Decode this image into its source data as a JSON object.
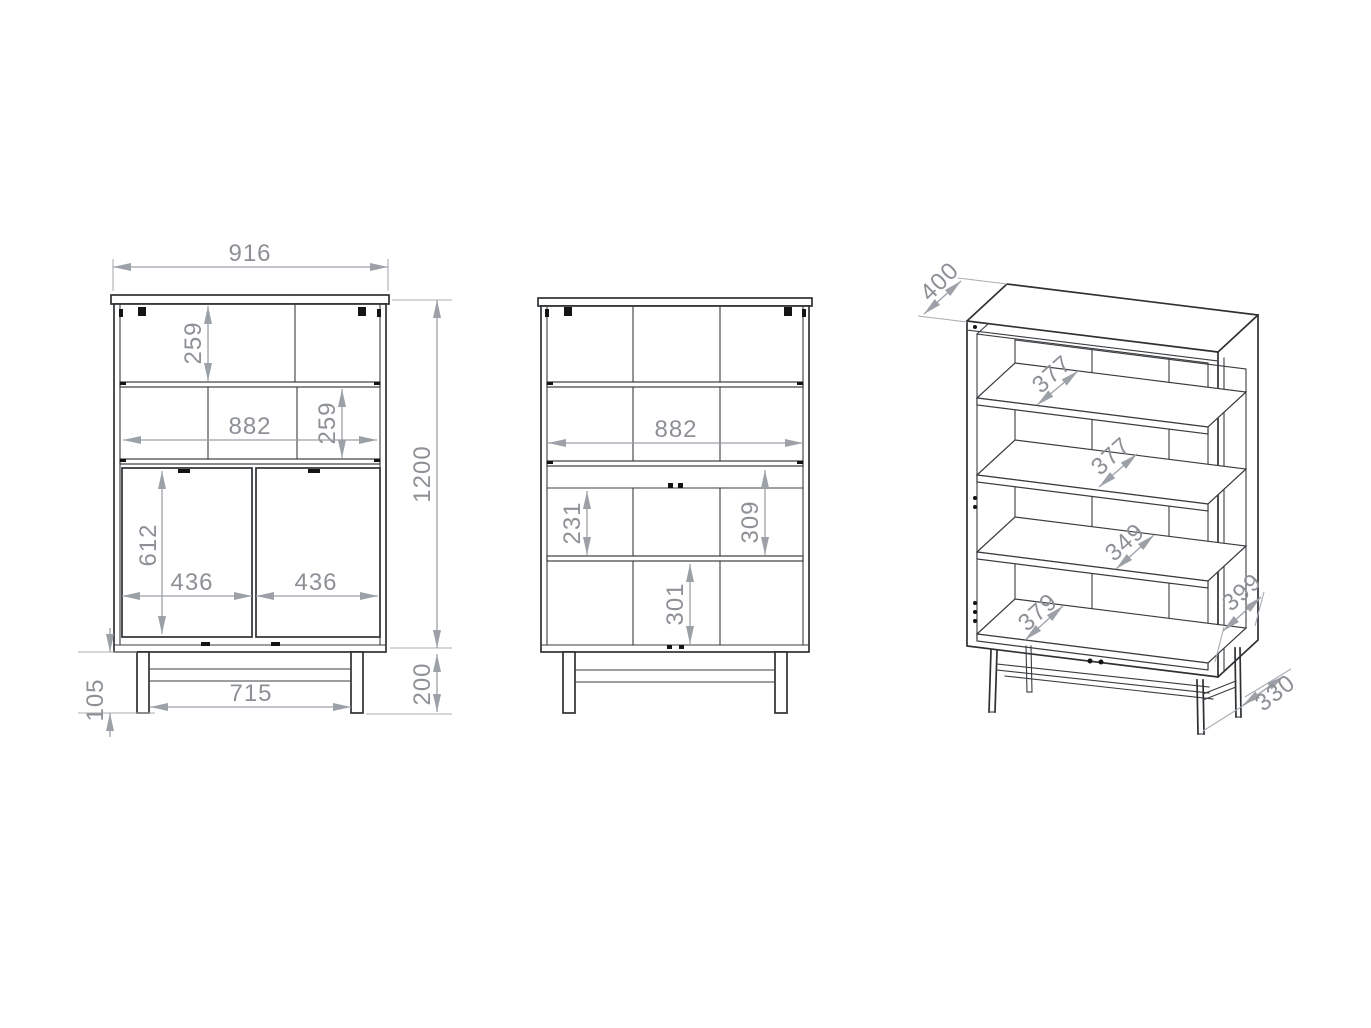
{
  "colors": {
    "background": "#ffffff",
    "structure_line": "#2e3134",
    "dimension_line": "#9ba1a6",
    "dimension_text": "#8d9196"
  },
  "front": {
    "dims": {
      "overall_width": "916",
      "top_shelf_height": "259",
      "interior_width": "882",
      "second_shelf_height": "259",
      "door_height": "612",
      "left_door_width": "436",
      "right_door_width": "436",
      "overall_height": "1200",
      "base_height": "200",
      "base_clearance": "105",
      "base_inner_width": "715"
    }
  },
  "interior": {
    "dims": {
      "interior_width": "882",
      "compartment_height_left": "231",
      "compartment_height_right": "309",
      "bottom_compartment_height": "301"
    }
  },
  "perspective": {
    "dims": {
      "top_depth": "400",
      "upper_shelf_depth": "377",
      "middle_shelf_depth": "377",
      "lower_shelf_depth": "349",
      "bottom_shelf_depth": "379",
      "side_depth": "399",
      "base_depth": "330"
    }
  }
}
